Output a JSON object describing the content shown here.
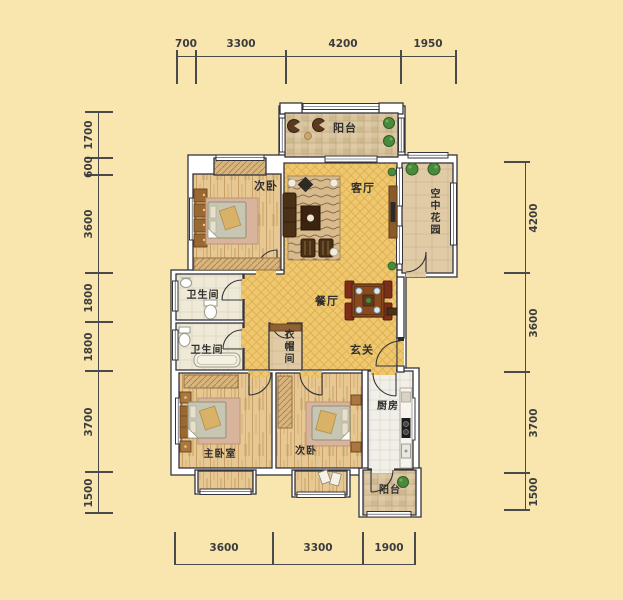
{
  "plan_title": "apartment-floor-plan",
  "rooms": {
    "balcony_top": {
      "label": "阳台"
    },
    "bedroom_top": {
      "label": "次卧"
    },
    "living": {
      "label": "客厅"
    },
    "sky_garden": {
      "label": "空中花园"
    },
    "bath_upper": {
      "label": "卫生间"
    },
    "bath_lower": {
      "label": "卫生间"
    },
    "dining": {
      "label": "餐厅"
    },
    "cloakroom": {
      "label": "衣帽间"
    },
    "foyer": {
      "label": "玄关"
    },
    "master_bedroom": {
      "label": "主卧室"
    },
    "bedroom_bottom": {
      "label": "次卧"
    },
    "kitchen": {
      "label": "厨房"
    },
    "balcony_bottom": {
      "label": "阳台"
    }
  },
  "dimensions": {
    "top": [
      "700",
      "3300",
      "4200",
      "1950"
    ],
    "bottom": [
      "3600",
      "3300",
      "1900"
    ],
    "left": [
      "1700",
      "600",
      "3600",
      "1800",
      "1800",
      "3700",
      "1500"
    ],
    "right": [
      "4200",
      "3600",
      "3700",
      "1500"
    ]
  },
  "colors": {
    "background": "#F8E6AE",
    "wall_line": "#34343C",
    "gold_floor": "#EFC76E",
    "wood_floor": "#E7C792",
    "tile_floor": "#D8C49E",
    "kitchen_tile": "#F1EFE8",
    "furniture_brown": "#9A6832",
    "plant_green": "#4A8A3C",
    "dimension_text": "#3C3C3C"
  }
}
